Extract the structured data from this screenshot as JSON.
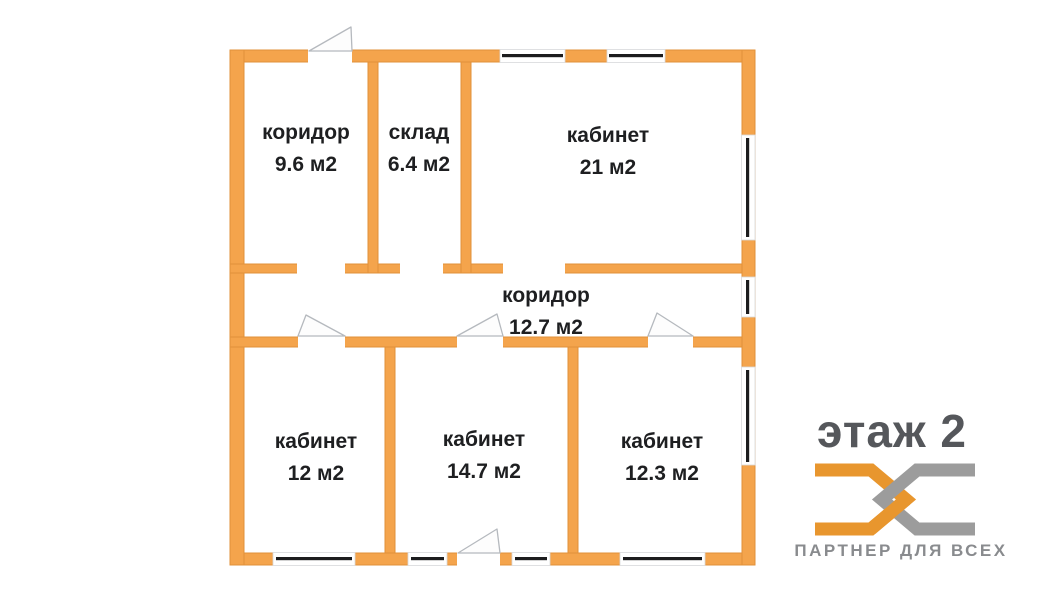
{
  "floor_plan": {
    "rooms": [
      {
        "name": "коридор",
        "area": "9.6 м2"
      },
      {
        "name": "склад",
        "area": "6.4 м2"
      },
      {
        "name": "кабинет",
        "area": "21 м2"
      },
      {
        "name": "коридор",
        "area": "12.7 м2"
      },
      {
        "name": "кабинет",
        "area": "12 м2"
      },
      {
        "name": "кабинет",
        "area": "14.7 м2"
      },
      {
        "name": "кабинет",
        "area": "12.3 м2"
      }
    ]
  },
  "brand": {
    "floor_label": "этаж 2",
    "tagline": "ПАРТНЕР ДЛЯ ВСЕХ"
  },
  "colors": {
    "wall_orange": "#F4A44C",
    "wall_edge": "#E1913A",
    "window_glass": "#1c1c1e",
    "label_text": "#1e1f21",
    "brand_gray": "#55575b",
    "logo_orange": "#E8962E",
    "logo_gray": "#9C9C9C",
    "tagline_gray": "#898b8e",
    "background": "#ffffff"
  }
}
